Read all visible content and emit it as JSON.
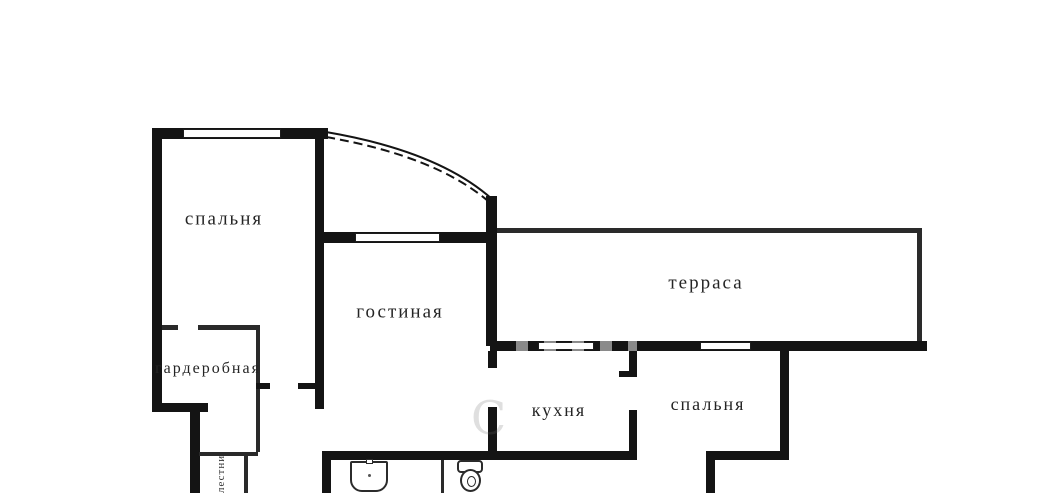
{
  "plan": {
    "background": "#ffffff",
    "wall_color": "#141414",
    "label_color": "#242424"
  },
  "rooms": [
    {
      "id": "bedroom-1",
      "label": "спальня",
      "cx": 224,
      "cy": 219,
      "size": 19
    },
    {
      "id": "living-room",
      "label": "гостиная",
      "cx": 400,
      "cy": 312,
      "size": 19
    },
    {
      "id": "terrace",
      "label": "терраса",
      "cx": 706,
      "cy": 283,
      "size": 19
    },
    {
      "id": "wardrobe",
      "label": "гардеробная",
      "cx": 208,
      "cy": 369,
      "size": 16
    },
    {
      "id": "kitchen",
      "label": "кухня",
      "cx": 559,
      "cy": 410,
      "size": 18
    },
    {
      "id": "bedroom-2",
      "label": "спальня",
      "cx": 708,
      "cy": 404,
      "size": 18
    }
  ],
  "vertical_label": {
    "text": "лестница"
  },
  "watermark": {
    "text": "С"
  },
  "walls": [
    {
      "name": "bedroom1-top-wall",
      "x": 152,
      "y": 128,
      "w": 176,
      "h": 11
    },
    {
      "name": "left-outer-wall",
      "x": 152,
      "y": 128,
      "w": 10,
      "h": 284
    },
    {
      "name": "left-step-bottom-wall",
      "x": 152,
      "y": 403,
      "w": 56,
      "h": 9
    },
    {
      "name": "left-step-vertical-wall",
      "x": 190,
      "y": 410,
      "w": 10,
      "h": 83
    },
    {
      "name": "bedroom1-wardrobe-divider-left",
      "x": 162,
      "y": 325,
      "w": 16,
      "h": 5,
      "thin": true
    },
    {
      "name": "bedroom1-wardrobe-divider-right",
      "x": 198,
      "y": 325,
      "w": 62,
      "h": 5,
      "thin": true
    },
    {
      "name": "wardrobe-right-wall",
      "x": 256,
      "y": 328,
      "w": 4,
      "h": 55,
      "thin": true
    },
    {
      "name": "wardrobe-door-jamb",
      "x": 256,
      "y": 383,
      "w": 14,
      "h": 6
    },
    {
      "name": "hall-door-jamb",
      "x": 298,
      "y": 383,
      "w": 17,
      "h": 6
    },
    {
      "name": "center-vertical-wall",
      "x": 315,
      "y": 128,
      "w": 9,
      "h": 281
    },
    {
      "name": "living-top-wall",
      "x": 324,
      "y": 232,
      "w": 166,
      "h": 11
    },
    {
      "name": "living-right-wall",
      "x": 486,
      "y": 196,
      "w": 11,
      "h": 150
    },
    {
      "name": "terrace-top-wall",
      "x": 497,
      "y": 228,
      "w": 421,
      "h": 5,
      "thin": true
    },
    {
      "name": "terrace-right-wall",
      "x": 917,
      "y": 228,
      "w": 5,
      "h": 118,
      "thin": true
    },
    {
      "name": "terrace-bottom-wall",
      "x": 490,
      "y": 341,
      "w": 437,
      "h": 10
    },
    {
      "name": "kitchen-left-wall-upper",
      "x": 488,
      "y": 351,
      "w": 9,
      "h": 17
    },
    {
      "name": "kitchen-left-wall-lower",
      "x": 488,
      "y": 407,
      "w": 9,
      "h": 48
    },
    {
      "name": "kitchen-right-wall-upper",
      "x": 629,
      "y": 351,
      "w": 8,
      "h": 26
    },
    {
      "name": "kitchen-door-jamb",
      "x": 619,
      "y": 371,
      "w": 10,
      "h": 6
    },
    {
      "name": "kitchen-right-wall-lower",
      "x": 629,
      "y": 410,
      "w": 8,
      "h": 45
    },
    {
      "name": "bath-kitchen-bottom-wall",
      "x": 322,
      "y": 451,
      "w": 315,
      "h": 9
    },
    {
      "name": "bath-left-wall",
      "x": 322,
      "y": 451,
      "w": 9,
      "h": 42
    },
    {
      "name": "bath-partition",
      "x": 441,
      "y": 460,
      "w": 3,
      "h": 33,
      "thin": true
    },
    {
      "name": "bedroom2-right-wall",
      "x": 780,
      "y": 345,
      "w": 9,
      "h": 115
    },
    {
      "name": "bedroom2-bottom-wall",
      "x": 706,
      "y": 451,
      "w": 83,
      "h": 9
    },
    {
      "name": "bedroom2-bottom-left-wall",
      "x": 706,
      "y": 455,
      "w": 9,
      "h": 38
    },
    {
      "name": "hall-strip-top-line",
      "x": 199,
      "y": 452,
      "w": 59,
      "h": 4,
      "thin": true
    },
    {
      "name": "hall-strip-vertical-line",
      "x": 244,
      "y": 456,
      "w": 4,
      "h": 37,
      "thin": true
    },
    {
      "name": "hall-left-partition",
      "x": 256,
      "y": 389,
      "w": 4,
      "h": 63,
      "thin": true
    }
  ],
  "windows": [
    {
      "name": "bedroom1-window",
      "x": 183,
      "y": 129,
      "w": 98,
      "h": 9
    },
    {
      "name": "living-window",
      "x": 355,
      "y": 233,
      "w": 85,
      "h": 9
    },
    {
      "name": "terrace-window-1",
      "x": 538,
      "y": 342,
      "w": 56,
      "h": 8
    },
    {
      "name": "terrace-window-2",
      "x": 700,
      "y": 342,
      "w": 51,
      "h": 8
    }
  ],
  "arc": {
    "solid": "M326,132 Q438,151 492,199",
    "dashed": "M326,137 Q435,156 488,201"
  }
}
